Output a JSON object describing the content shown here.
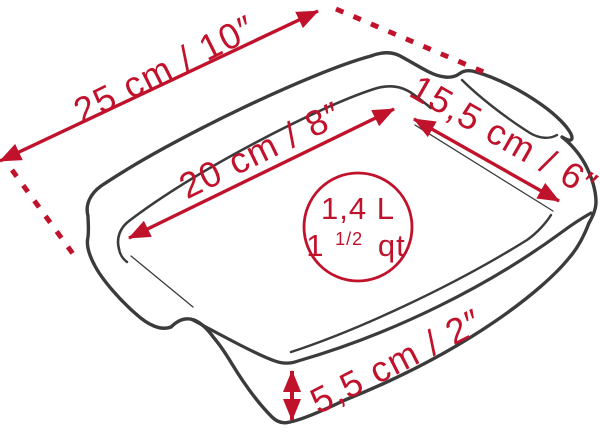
{
  "diagram": {
    "title": "rectangular baking dish dimension drawing",
    "colors": {
      "background": "#ffffff",
      "outline": "#3b3b3b",
      "accent": "#c1122c"
    },
    "dimensions": {
      "outer_length": "25 cm / 10″",
      "inner_length": "20 cm / 8″",
      "width": "15,5 cm / 6″",
      "height": "5,5 cm / 2″"
    },
    "capacity": {
      "liters": "1,4 L",
      "quarts_whole": "1",
      "quarts_fraction": "1/2",
      "quarts_unit": "qt"
    }
  }
}
